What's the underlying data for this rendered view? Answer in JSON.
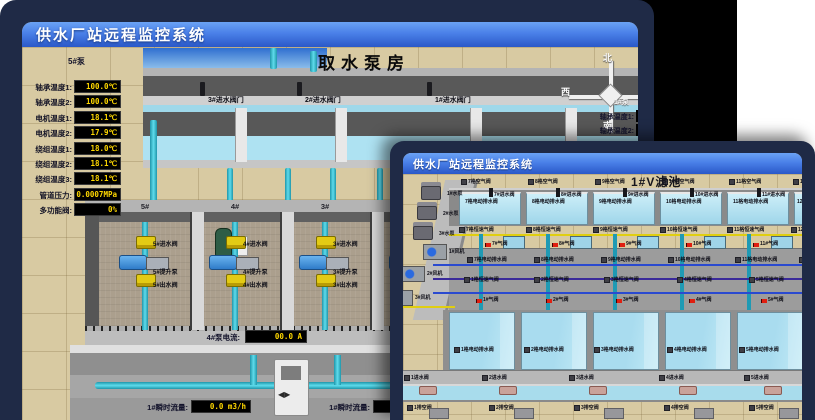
{
  "back_window": {
    "title": "供水厂站远程监控系统",
    "scene_title": "取水泵房",
    "pump_panel": {
      "header": "5#泵",
      "rows": [
        {
          "label": "轴承温度1:",
          "value": "100.0℃"
        },
        {
          "label": "轴承温度2:",
          "value": "100.0℃"
        },
        {
          "label": "电机温度1:",
          "value": "18.1℃"
        },
        {
          "label": "电机温度2:",
          "value": "17.9℃"
        },
        {
          "label": "绕组温度1:",
          "value": "18.0℃"
        },
        {
          "label": "绕组温度2:",
          "value": "18.1℃"
        },
        {
          "label": "绕组温度3:",
          "value": "18.1℃"
        },
        {
          "label": "管道压力:",
          "value": "0.0007MPa"
        },
        {
          "label": "多功能阀:",
          "value": "0%"
        }
      ]
    },
    "right_panel": {
      "header": "1#泵",
      "labels": [
        "轴承温度1:",
        "轴承温度2:"
      ]
    },
    "compass": {
      "north": "北",
      "west": "西",
      "south": "南",
      "east": "东"
    },
    "intake_valve_labels": [
      "3#进水阀门",
      "2#进水阀门",
      "1#进水阀门"
    ],
    "bay_ids": [
      "5#",
      "4#",
      "3#",
      "2#",
      "1#"
    ],
    "bay_valve_suffixes": {
      "in": "进水阀",
      "pump": "提升泵",
      "out": "出水阀"
    },
    "current_displays": [
      {
        "label": "4#泵电流:",
        "value": "00.0 A"
      },
      {
        "label": "2#泵电流:",
        "value": "00.0 A"
      }
    ],
    "flow_displays": [
      {
        "label": "1#瞬时流量:",
        "value": "0.0 m3/h"
      },
      {
        "label": "1#瞬时流量:",
        "value": "0.0 m3/h"
      }
    ]
  },
  "front_window": {
    "title": "供水厂站远程监控系统",
    "scene_title": "1#V滤池",
    "left_equipment": [
      "1#水泵",
      "2#水泵",
      "3#水泵",
      "1#风机",
      "2#风机",
      "3#风机"
    ],
    "label_rows": {
      "air_valves": [
        "7格空气阀",
        "8格空气阀",
        "9格空气阀",
        "10格空气阀",
        "11格空气阀",
        "12格空气阀"
      ],
      "inlet_valves_back": [
        "7#进水阀",
        "8#进水阀",
        "9#进水阀",
        "10#进水阀",
        "11#进水阀",
        "12#进水阀"
      ],
      "drain_valves_back": [
        "7格电动排水阀",
        "8格电动排水阀",
        "9格电动排水阀",
        "10格电动排水阀",
        "11格电动排水阀",
        "12格电动排水阀"
      ],
      "speed_valves_back": [
        "7格恒速气阀",
        "8格恒速气阀",
        "9格恒速气阀",
        "10格恒速气阀",
        "11格恒速气阀",
        "12格恒速气阀"
      ],
      "gas_valves_back": [
        "7#气阀",
        "8#气阀",
        "9#气阀",
        "10#气阀",
        "11#气阀"
      ],
      "speed_valves_front": [
        "1格恒速气阀",
        "2格恒速气阀",
        "3格恒速气阀",
        "4格恒速气阀",
        "5格恒速气阀"
      ],
      "gas_valves_front": [
        "1#气阀",
        "2#气阀",
        "3#气阀",
        "4#气阀",
        "5#气阀"
      ],
      "drain_valves_front": [
        "1格电动排水阀",
        "2格电动排水阀",
        "3格电动排水阀",
        "4格电动排水阀",
        "5格电动排水阀"
      ],
      "inlet_valves_front": [
        "1进水阀",
        "2进水阀",
        "3进水阀",
        "4进水阀",
        "5进水阀"
      ],
      "empty_valves_front": [
        "1排空阀",
        "2排空阀",
        "3排空阀",
        "4排空阀",
        "5排空阀"
      ]
    }
  },
  "colors": {
    "frame": "#1f2a46",
    "titlebar_top": "#6aa2f5",
    "titlebar_bottom": "#2a58c8",
    "ground": "#d8caa2",
    "water": "#aee2f2",
    "pipe_cyan": "#3fc6d8",
    "valve_yellow": "#e3cb14",
    "display_text": "#ffd800",
    "alarm_red": "#e01f10"
  }
}
